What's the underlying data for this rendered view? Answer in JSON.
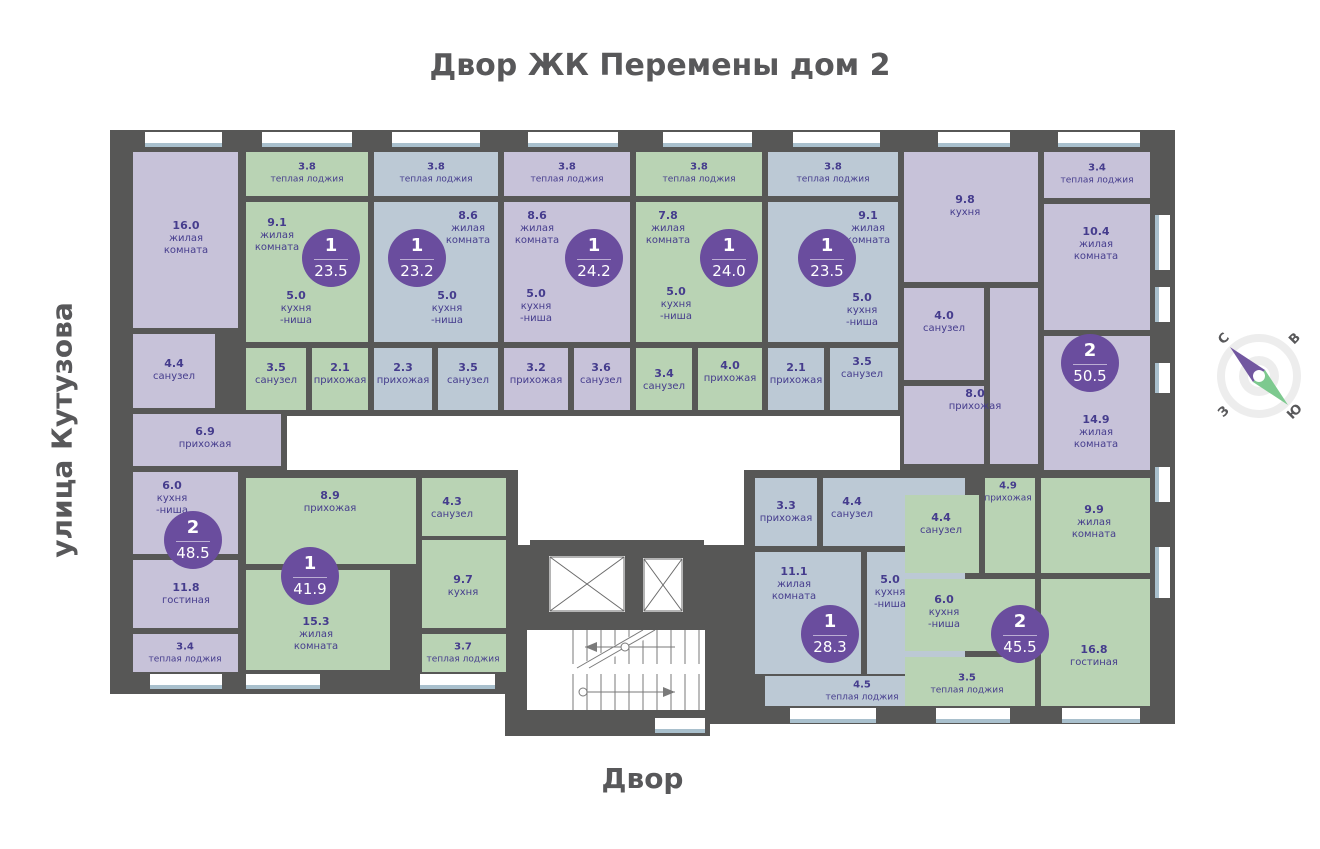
{
  "title": "Двор ЖК Перемены дом 2",
  "street_label": "улица Кутузова",
  "yard_label": "Двор",
  "compass": {
    "north": "С",
    "east": "В",
    "south": "Ю",
    "west": "З"
  },
  "colors": {
    "wall": "#575756",
    "purple": "#c7c2d9",
    "green": "#b9d3b4",
    "blue": "#bcc9d5",
    "badge": "#6a4d9e",
    "label": "#453c8d",
    "corridor": "#ffffff",
    "sill": "#a9c0cd",
    "title": "#58585a",
    "compass_north": "#7257a0",
    "compass_south": "#7dc98f"
  },
  "apartments": [
    {
      "rooms_count": "2",
      "area": "48.5",
      "color": "purple",
      "rooms": [
        {
          "area": "16.0",
          "name": "жилая\nкомната"
        },
        {
          "area": "4.4",
          "name": "санузел"
        },
        {
          "area": "6.9",
          "name": "прихожая"
        },
        {
          "area": "6.0",
          "name": "кухня\n-ниша"
        },
        {
          "area": "11.8",
          "name": "гостиная"
        },
        {
          "area": "3.4",
          "name": "теплая лоджия"
        }
      ]
    },
    {
      "rooms_count": "1",
      "area": "23.5",
      "color": "green",
      "rooms": [
        {
          "area": "3.8",
          "name": "теплая лоджия"
        },
        {
          "area": "9.1",
          "name": "жилая\nкомната"
        },
        {
          "area": "5.0",
          "name": "кухня\n-ниша"
        },
        {
          "area": "3.5",
          "name": "санузел"
        },
        {
          "area": "2.1",
          "name": "прихожая"
        }
      ]
    },
    {
      "rooms_count": "1",
      "area": "23.2",
      "color": "blue",
      "rooms": [
        {
          "area": "3.8",
          "name": "теплая лоджия"
        },
        {
          "area": "8.6",
          "name": "жилая\nкомната"
        },
        {
          "area": "5.0",
          "name": "кухня\n-ниша"
        },
        {
          "area": "2.3",
          "name": "прихожая"
        },
        {
          "area": "3.5",
          "name": "санузел"
        }
      ]
    },
    {
      "rooms_count": "1",
      "area": "24.2",
      "color": "purple",
      "rooms": [
        {
          "area": "3.8",
          "name": "теплая лоджия"
        },
        {
          "area": "8.6",
          "name": "жилая\nкомната"
        },
        {
          "area": "5.0",
          "name": "кухня\n-ниша"
        },
        {
          "area": "3.2",
          "name": "прихожая"
        },
        {
          "area": "3.6",
          "name": "санузел"
        }
      ]
    },
    {
      "rooms_count": "1",
      "area": "24.0",
      "color": "green",
      "rooms": [
        {
          "area": "3.8",
          "name": "теплая лоджия"
        },
        {
          "area": "7.8",
          "name": "жилая\nкомната"
        },
        {
          "area": "5.0",
          "name": "кухня\n-ниша"
        },
        {
          "area": "3.4",
          "name": "санузел"
        },
        {
          "area": "4.0",
          "name": "прихожая"
        }
      ]
    },
    {
      "rooms_count": "1",
      "area": "23.5",
      "color": "blue",
      "rooms": [
        {
          "area": "3.8",
          "name": "теплая лоджия"
        },
        {
          "area": "9.1",
          "name": "жилая\nкомната"
        },
        {
          "area": "5.0",
          "name": "кухня\n-ниша"
        },
        {
          "area": "2.1",
          "name": "прихожая"
        },
        {
          "area": "3.5",
          "name": "санузел"
        }
      ]
    },
    {
      "rooms_count": "2",
      "area": "50.5",
      "color": "purple",
      "rooms": [
        {
          "area": "9.8",
          "name": "кухня"
        },
        {
          "area": "3.4",
          "name": "теплая лоджия"
        },
        {
          "area": "10.4",
          "name": "жилая\nкомната"
        },
        {
          "area": "4.0",
          "name": "санузел"
        },
        {
          "area": "8.0",
          "name": "прихожая"
        },
        {
          "area": "14.9",
          "name": "жилая\nкомната"
        }
      ]
    },
    {
      "rooms_count": "1",
      "area": "41.9",
      "color": "green",
      "rooms": [
        {
          "area": "8.9",
          "name": "прихожая"
        },
        {
          "area": "4.3",
          "name": "санузел"
        },
        {
          "area": "9.7",
          "name": "кухня"
        },
        {
          "area": "15.3",
          "name": "жилая\nкомната"
        },
        {
          "area": "3.7",
          "name": "теплая лоджия"
        }
      ]
    },
    {
      "rooms_count": "1",
      "area": "28.3",
      "color": "blue",
      "rooms": [
        {
          "area": "3.3",
          "name": "прихожая"
        },
        {
          "area": "4.4",
          "name": "санузел"
        },
        {
          "area": "11.1",
          "name": "жилая\nкомната"
        },
        {
          "area": "5.0",
          "name": "кухня\n-ниша"
        },
        {
          "area": "4.5",
          "name": "теплая лоджия"
        }
      ]
    },
    {
      "rooms_count": "2",
      "area": "45.5",
      "color": "green",
      "rooms": [
        {
          "area": "4.9",
          "name": "прихожая"
        },
        {
          "area": "4.4",
          "name": "санузел"
        },
        {
          "area": "9.9",
          "name": "жилая\nкомната"
        },
        {
          "area": "6.0",
          "name": "кухня\n-ниша"
        },
        {
          "area": "16.8",
          "name": "гостиная"
        },
        {
          "area": "3.5",
          "name": "теплая лоджия"
        }
      ]
    }
  ]
}
